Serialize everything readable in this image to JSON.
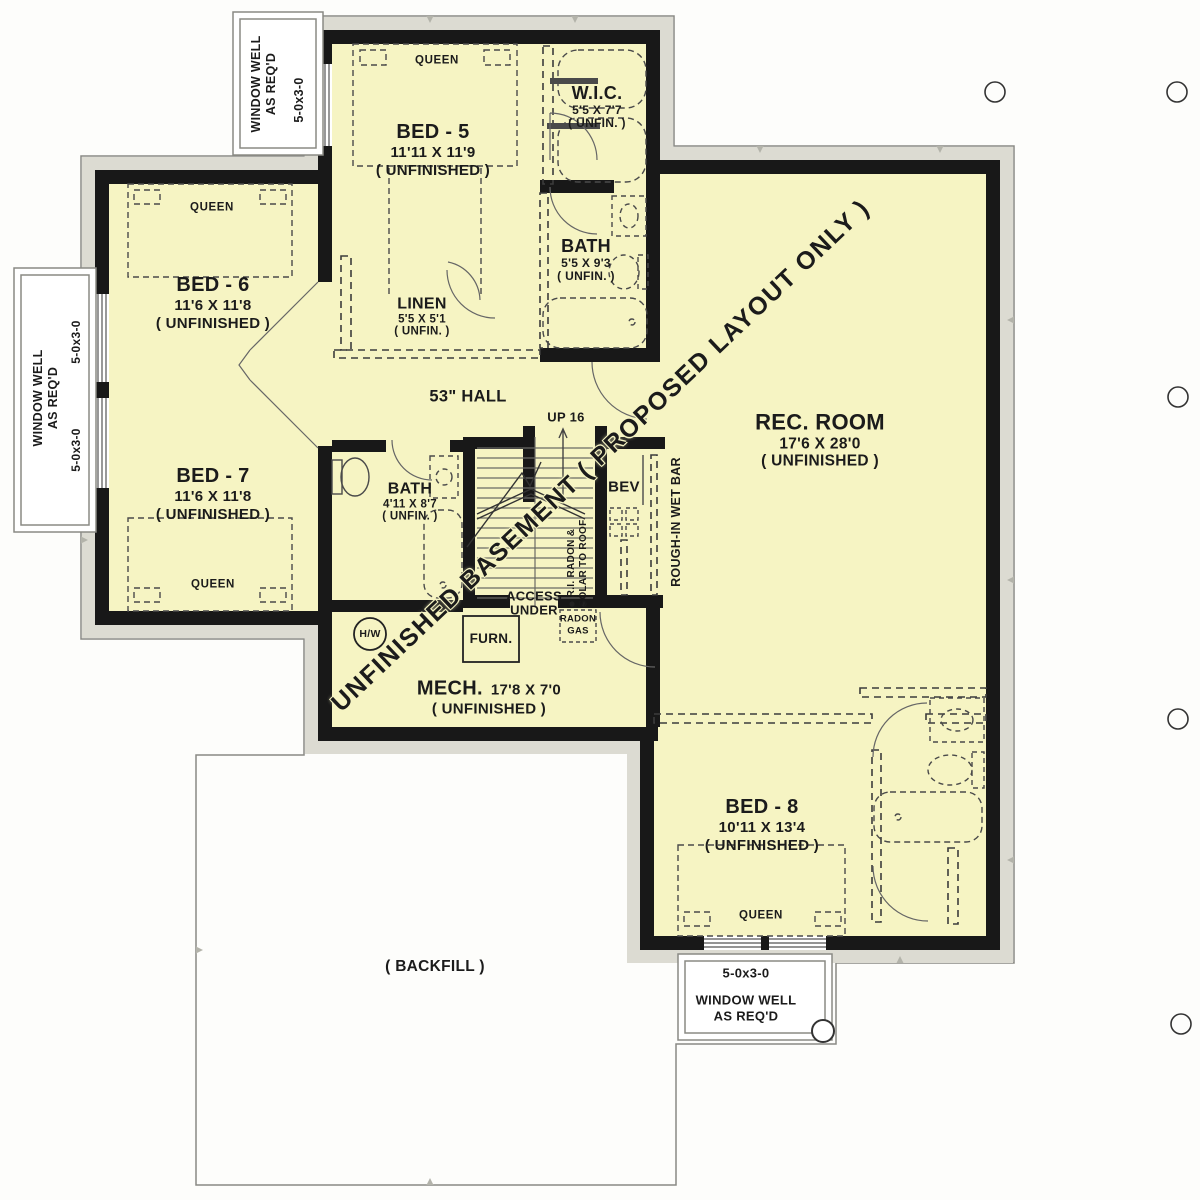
{
  "plan": {
    "watermark": "UNFINISHED BASEMENT ( PROPOSED LAYOUT ONLY )",
    "rooms": [
      {
        "name": "BED - 5",
        "dims": "11'11 X 11'9",
        "status": "( UNFINISHED )",
        "furniture": "QUEEN"
      },
      {
        "name": "W.I.C.",
        "dims": "5'5 X 7'7",
        "status": "( UNFIN. )"
      },
      {
        "name": "BATH",
        "dims": "5'5 X 9'3",
        "status": "( UNFIN. )"
      },
      {
        "name": "LINEN",
        "dims": "5'5 X 5'1",
        "status": "( UNFIN. )"
      },
      {
        "name": "BED - 6",
        "dims": "11'6 X 11'8",
        "status": "( UNFINISHED )",
        "furniture": "QUEEN"
      },
      {
        "name": "BED - 7",
        "dims": "11'6 X 11'8",
        "status": "( UNFINISHED )",
        "furniture": "QUEEN"
      },
      {
        "name": "BATH",
        "dims": "4'11 X 8'7",
        "status": "( UNFIN. )"
      },
      {
        "name": "REC. ROOM",
        "dims": "17'6 X 28'0",
        "status": "( UNFINISHED )"
      },
      {
        "name": "MECH.",
        "dims": "17'8 X 7'0",
        "status": "( UNFINISHED )"
      },
      {
        "name": "BED - 8",
        "dims": "10'11 X 13'4",
        "status": "( UNFINISHED )",
        "furniture": "QUEEN"
      }
    ],
    "labels": {
      "hall": "53\" HALL",
      "stairs": "UP 16",
      "bev": "BEV",
      "wet_bar": "ROUGH-IN WET BAR",
      "radon_line1": "R.I. RADON &",
      "radon_line2": "SOLAR TO ROOF",
      "access_line1": "ACCESS",
      "access_line2": "UNDER",
      "radon_box_line1": "RADON",
      "radon_box_line2": "GAS",
      "water_heater": "H/W",
      "furnace": "FURN.",
      "backfill": "( BACKFILL )"
    },
    "window_wells": {
      "top": {
        "line1": "WINDOW WELL",
        "line2": "AS REQ'D",
        "size": "5-0x3-0"
      },
      "left": {
        "line1": "WINDOW WELL",
        "line2": "AS REQ'D",
        "size1": "5-0x3-0",
        "size2": "5-0x3-0"
      },
      "bottom": {
        "line1": "WINDOW WELL",
        "line2": "AS REQ'D",
        "size": "5-0x3-0"
      }
    },
    "colors": {
      "room_fill": "#f6f4c3",
      "wall": "#181818",
      "band": "#dcdbd2",
      "outline": "#8a8a84"
    }
  }
}
